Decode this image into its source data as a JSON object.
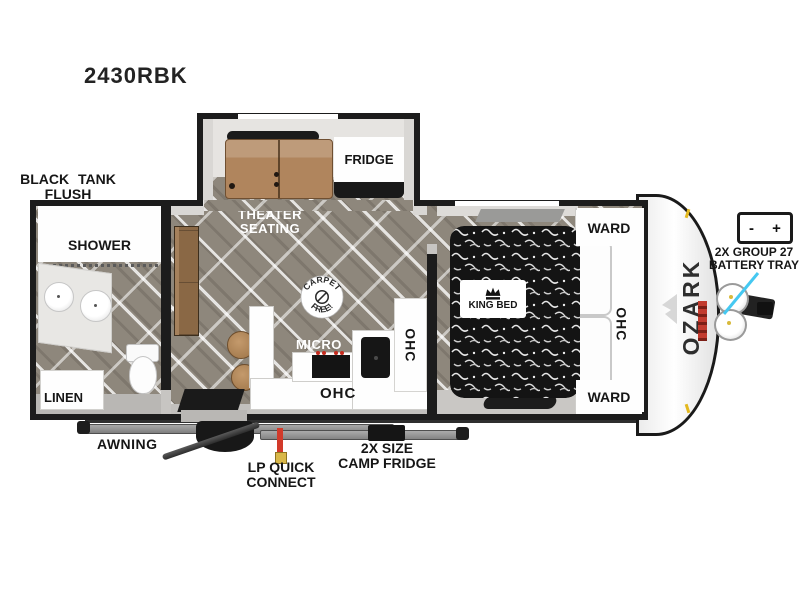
{
  "title": "2430RBK",
  "brand": "OZARK",
  "badge": {
    "top": "CARPET",
    "bottom": "FREE!"
  },
  "slideout": {
    "fridge": "FRIDGE",
    "theater_line1": "THEATER",
    "theater_line2": "SEATING"
  },
  "bathroom": {
    "shower": "SHOWER",
    "linen": "LINEN"
  },
  "kitchen": {
    "micro": "MICRO",
    "ohc_bottom": "OHC",
    "ohc_side": "OHC"
  },
  "bedroom": {
    "bed": "KING BED",
    "ward_top": "WARD",
    "ward_bottom": "WARD",
    "ohc": "OHC"
  },
  "annotations": {
    "black_tank_flush_line1": "BLACK TANK",
    "black_tank_flush_line2": "FLUSH",
    "awning": "AWNING",
    "lp_line1": "LP QUICK",
    "lp_line2": "CONNECT",
    "camp_fridge_line1": "2X SIZE",
    "camp_fridge_line2": "CAMP FRIDGE",
    "battery_line1": "2X GROUP 27",
    "battery_line2": "BATTERY TRAY",
    "battery_minus": "-",
    "battery_plus": "+"
  },
  "colors": {
    "arrow_cyan": "#45c8f1",
    "lp_red": "#d23a2a",
    "lp_yellow": "#d9b84a",
    "seat_brown": "#b0855d",
    "floor_gray_brown": "#8e877c"
  }
}
